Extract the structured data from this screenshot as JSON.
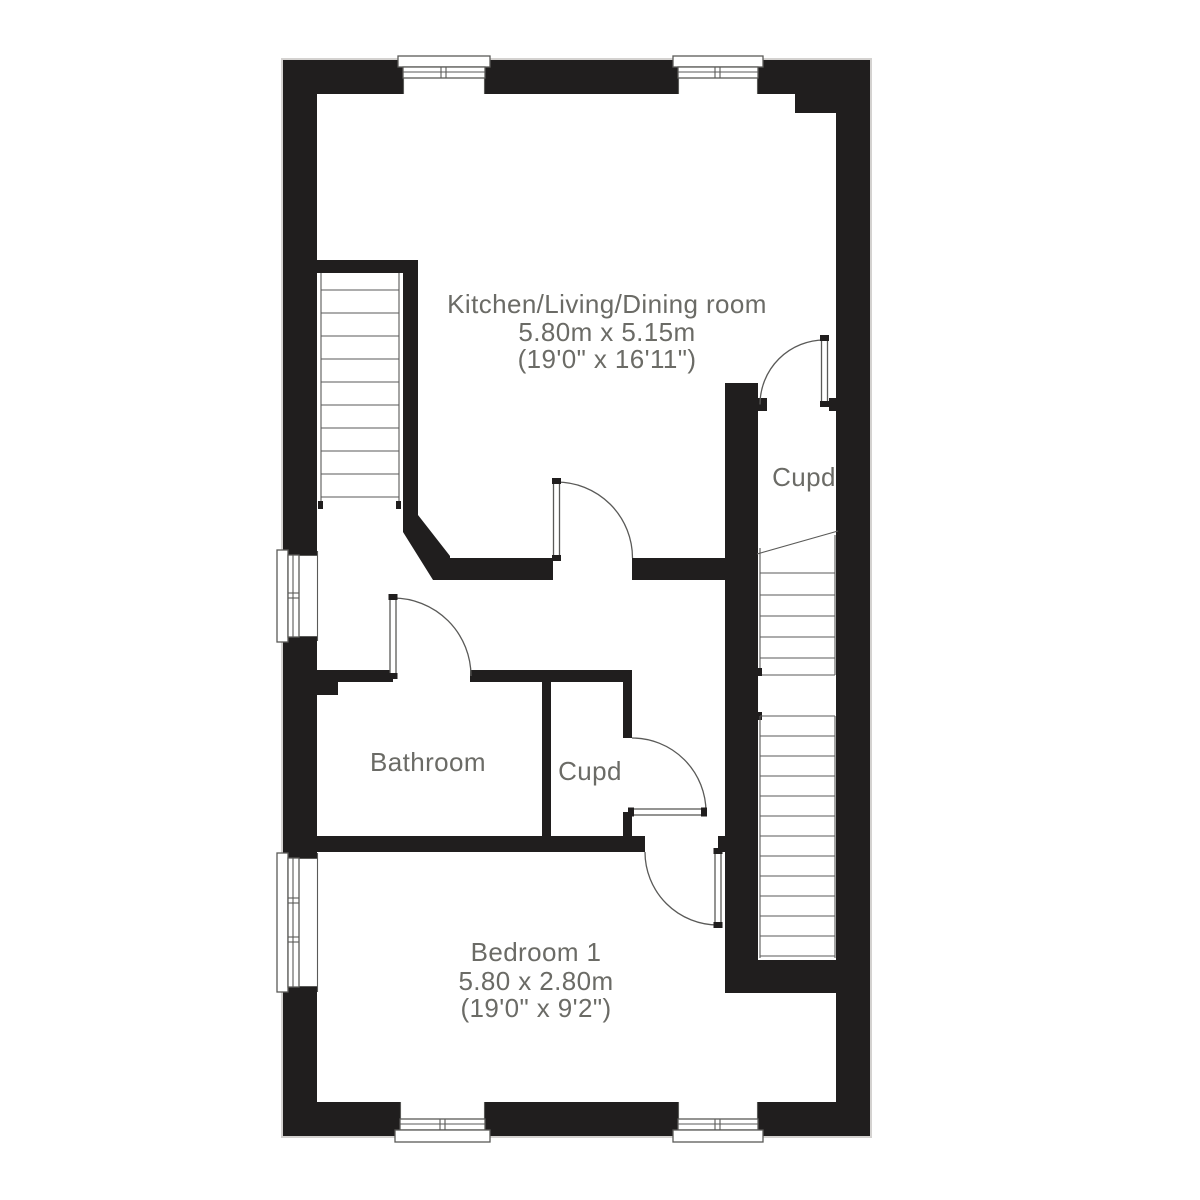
{
  "colors": {
    "wall": "#201e1e",
    "line": "#5a5a58",
    "text": "#6b6b66",
    "background": "#ffffff"
  },
  "rooms": [
    {
      "id": "kitchen-living-dining",
      "name": "Kitchen/Living/Dining room",
      "size_metric": "5.80m x 5.15m",
      "size_imperial": "(19'0\" x 16'11\")"
    },
    {
      "id": "cupboard-upper",
      "name": "Cupd"
    },
    {
      "id": "bathroom",
      "name": "Bathroom"
    },
    {
      "id": "cupboard-lower",
      "name": "Cupd"
    },
    {
      "id": "bedroom-1",
      "name": "Bedroom 1",
      "size_metric": "5.80 x 2.80m",
      "size_imperial": "(19'0\" x 9'2\")"
    }
  ],
  "features": {
    "doors": [
      "cupboard-upper-door",
      "kitchen-hall-door",
      "bathroom-door",
      "cupboard-lower-door",
      "bedroom-door"
    ],
    "stairs": [
      "stairs-upper-left",
      "stairs-right"
    ],
    "windows": [
      "window-top-1",
      "window-top-2",
      "window-left-1",
      "window-left-2",
      "window-bottom-1",
      "window-bottom-2"
    ]
  }
}
